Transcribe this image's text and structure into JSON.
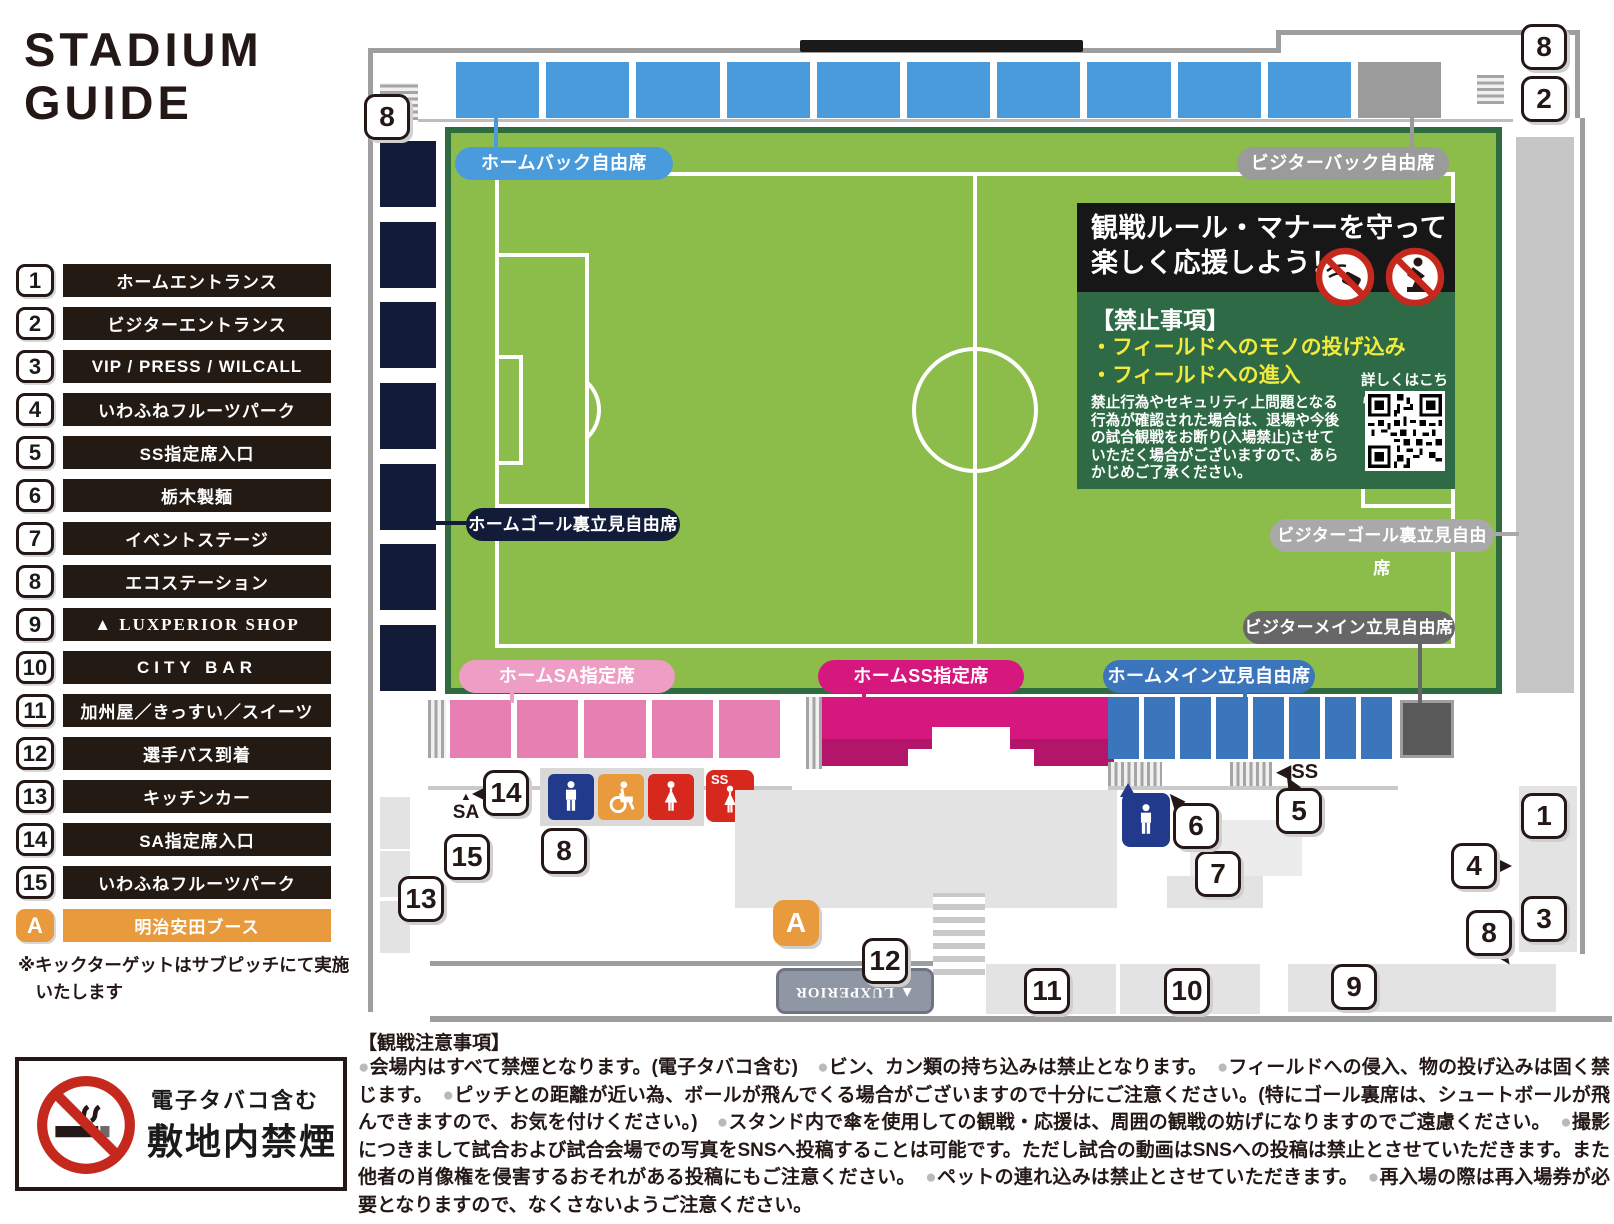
{
  "title": {
    "line1": "STADIUM",
    "line2": "GUIDE"
  },
  "legend": {
    "items": [
      {
        "num": "1",
        "label": "ホームエントランス"
      },
      {
        "num": "2",
        "label": "ビジターエントランス"
      },
      {
        "num": "3",
        "label": "VIP / PRESS / WILCALL"
      },
      {
        "num": "4",
        "label": "いわふねフルーツパーク"
      },
      {
        "num": "5",
        "label": "SS指定席入口"
      },
      {
        "num": "6",
        "label": "栃木製麺"
      },
      {
        "num": "7",
        "label": "イベントステージ"
      },
      {
        "num": "8",
        "label": "エコステーション"
      },
      {
        "num": "9",
        "label": "▲ LUXPERIOR SHOP"
      },
      {
        "num": "10",
        "label": "CITY BAR"
      },
      {
        "num": "11",
        "label": "加州屋／きっすい／スイーツ"
      },
      {
        "num": "12",
        "label": "選手バス到着"
      },
      {
        "num": "13",
        "label": "キッチンカー"
      },
      {
        "num": "14",
        "label": "SA指定席入口"
      },
      {
        "num": "15",
        "label": "いわふねフルーツパーク"
      },
      {
        "num": "A",
        "label": "明治安田ブース"
      }
    ],
    "note": "※キックターゲットはサブピッチにて実施\n　いたします"
  },
  "map": {
    "seat_labels": {
      "home_back": "ホームバック自由席",
      "visitor_back": "ビジターバック自由席",
      "home_goal_back": "ホームゴール裏立見自由席",
      "visitor_goal_back": "ビジターゴール裏立見自由席",
      "visitor_main": "ビジターメイン立見自由席",
      "home_sa": "ホームSA指定席",
      "home_ss": "ホームSS指定席",
      "home_main": "ホームメイン立見自由席"
    },
    "badges": {
      "top_left_8": "8",
      "top_right_8": "8",
      "top_right_2": "2",
      "sa_entrance_14": "14",
      "sa_area_15": "15",
      "kitchen_13": "13",
      "eco_mid_8": "8",
      "booth_a": "A",
      "bus_12": "12",
      "shops_11": "11",
      "bar_10": "10",
      "shop_9": "9",
      "stage_7": "7",
      "noodle_6": "6",
      "ss_entrance_5": "5",
      "home_entrance_1": "1",
      "fruit_park_4": "4",
      "vip_3": "3",
      "eco_right_8": "8"
    },
    "gates": {
      "sa_arrow": "▲",
      "sa": "SA",
      "ss": "◀SS",
      "ss_icon": "SS"
    },
    "bus_label": "▲ LUXPERIOR"
  },
  "rules_box": {
    "title_line1": "観戦ルール・マナーを守って",
    "title_line2": "楽しく応援しよう！",
    "prohibited_heading": "【禁止事項】",
    "prohibited_item1": "・フィールドへのモノの投げ込み",
    "prohibited_item2": "・フィールドへの進入",
    "body": "禁止行為やセキュリティ上問題となる行為が確認された場合は、退場や今後の試合観戦をお断り(入場禁止)させていただく場合がございますので、あらかじめご了承ください。",
    "qr_label": "詳しくはこちら"
  },
  "no_smoking": {
    "line1": "電子タバコ含む",
    "line2": "敷地内禁煙"
  },
  "notes": {
    "heading": "【観戦注意事項】",
    "body": "●会場内はすべて禁煙となります。(電子タバコ含む)　●ビン、カン類の持ち込みは禁止となります。　●フィールドへの侵入、物の投げ込みは固く禁じます。　●ピッチとの距離が近い為、ボールが飛んでくる場合がございますので十分にご注意ください。(特にゴール裏席は、シュートボールが飛んできますので、お気を付けください。)　●スタンド内で傘を使用しての観戦・応援は、周囲の観戦の妨げになりますのでご遠慮ください。　●撮影につきまして試合および試合会場での写真をSNSへ投稿することは可能です。ただし試合の動画はSNSへの投稿は禁止とさせていただきます。また他者の肖像権を侵害するおそれがある投稿にもご注意ください。　●ペットの連れ込みは禁止とさせていただきます。　●再入場の際は再入場券が必要となりますので、なくさないようご注意ください。"
  },
  "colors": {
    "home_back_blue": "#4a9bdc",
    "visitor_gray": "#9b9b9b",
    "goal_back_navy": "#121c39",
    "sa_pink_pill": "#ee9dc4",
    "sa_pink_block": "#e77fb2",
    "ss_magenta": "#d6187e",
    "ss_magenta_dark": "#b3156b",
    "main_blue": "#3b76bd",
    "visitor_main_dark": "#676767",
    "field_green": "#8cbc4a",
    "field_border_green": "#2e6b3f",
    "rules_green": "#2d6a45",
    "accent_orange": "#e89a3d",
    "alert_red": "#d7281e",
    "mens_navy": "#213a8c",
    "prohibited_yellow": "#f3ea3d"
  }
}
